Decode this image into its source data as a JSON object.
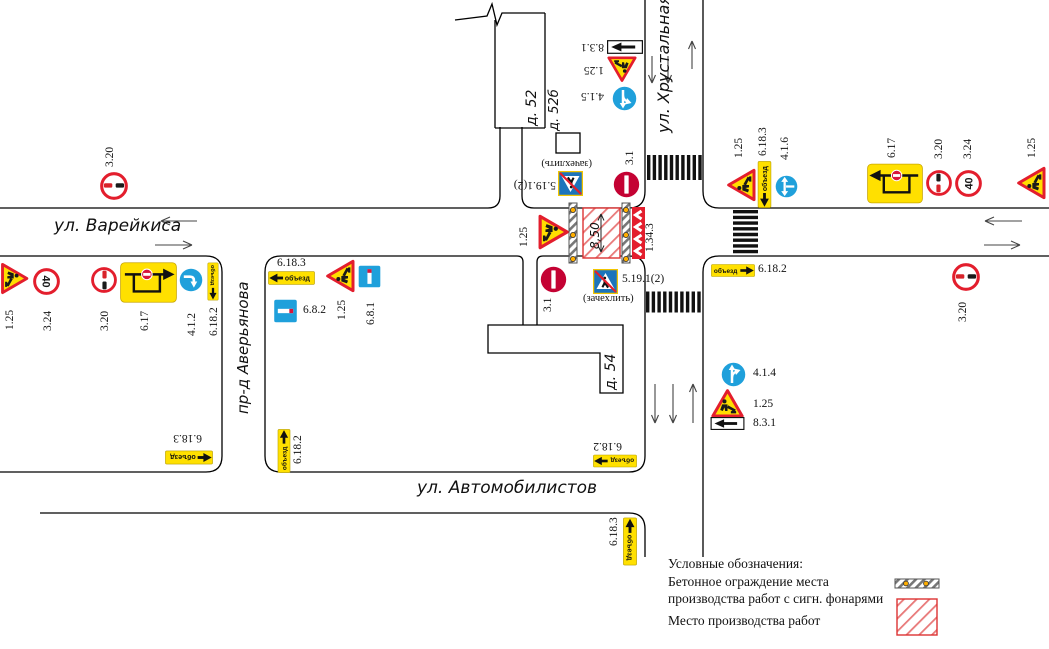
{
  "streets": [
    {
      "name": "street-label-vareykisa",
      "text": "ул. Варейкиса",
      "x": 54,
      "y": 216,
      "rot": 0,
      "size": 17
    },
    {
      "name": "street-label-khrustalnaya",
      "text": "ул. Хрустальная",
      "x": 654,
      "y": 133,
      "rot": -90,
      "size": 16
    },
    {
      "name": "street-label-averyanova",
      "text": "пр-д Аверьянова",
      "x": 234,
      "y": 414,
      "rot": -90,
      "size": 15
    },
    {
      "name": "street-label-avtomobilistov",
      "text": "ул. Автомобилистов",
      "x": 417,
      "y": 478,
      "rot": 0,
      "size": 17
    }
  ],
  "buildings": [
    {
      "name": "building-label-d52",
      "text": "д. 52",
      "x": 524,
      "y": 126,
      "rot": -90,
      "size": 14
    },
    {
      "name": "building-label-d52b",
      "text": "д. 52б",
      "x": 547,
      "y": 131,
      "rot": -90,
      "size": 13
    },
    {
      "name": "building-label-d54",
      "text": "д. 54",
      "x": 603,
      "y": 390,
      "rot": -90,
      "size": 14
    }
  ],
  "workzone": {
    "dimension": "8,50",
    "dim_x": 588,
    "dim_y": 249,
    "dim_rot": -90,
    "dim_size": 12
  },
  "legend": {
    "title": "Условные обозначения:",
    "item1_line1": "Бетонное ограждение места",
    "item1_line2": "производства работ с сигн. фонарями",
    "item2": "Место производства работ"
  },
  "signs": [
    {
      "name": "sign-320-nw",
      "code": "3.20",
      "type": "c320",
      "x": 114,
      "y": 186,
      "w": 28,
      "h": 28,
      "rot": 0,
      "label": {
        "x": 104,
        "y": 167,
        "rot": -90
      }
    },
    {
      "name": "sign-125-w",
      "code": "1.25",
      "type": "tri",
      "x": 15,
      "y": 278,
      "w": 32,
      "h": 29,
      "rot": 90,
      "label": {
        "x": 4,
        "y": 330,
        "rot": -90
      }
    },
    {
      "name": "sign-324-w",
      "code": "3.24",
      "type": "c40",
      "value": "40",
      "x": 46,
      "y": 281,
      "w": 27,
      "h": 27,
      "rot": 90,
      "label": {
        "x": 42,
        "y": 331,
        "rot": -90
      }
    },
    {
      "name": "sign-320-w",
      "code": "3.20",
      "type": "c320",
      "x": 104,
      "y": 280,
      "w": 26,
      "h": 26,
      "rot": 90,
      "label": {
        "x": 99,
        "y": 331,
        "rot": -90
      }
    },
    {
      "name": "sign-617-w",
      "code": "6.17",
      "type": "scheme",
      "variant": "right",
      "x": 148,
      "y": 282,
      "w": 57,
      "h": 41,
      "rot": 0,
      "label": {
        "x": 139,
        "y": 331,
        "rot": -90
      }
    },
    {
      "name": "sign-412-w",
      "code": "4.1.2",
      "type": "cblue",
      "variant": "right",
      "x": 191,
      "y": 280,
      "w": 24,
      "h": 24,
      "rot": 90,
      "label": {
        "x": 186,
        "y": 336,
        "rot": -90
      }
    },
    {
      "name": "sign-6182-w",
      "code": "6.18.2",
      "type": "plate",
      "variant": "right",
      "text": "объезд",
      "x": 213,
      "y": 281,
      "w": 38,
      "h": 13,
      "rot": 90,
      "label": {
        "x": 208,
        "y": 336,
        "rot": -90
      }
    },
    {
      "name": "sign-6183-mid",
      "code": "6.18.3",
      "type": "plate",
      "variant": "left",
      "text": "объезд",
      "x": 291,
      "y": 278,
      "w": 47,
      "h": 16,
      "rot": 0,
      "label": {
        "x": 277,
        "y": 257,
        "rot": 0
      }
    },
    {
      "name": "sign-682-mid",
      "code": "6.8.2",
      "type": "dead",
      "variant": "h",
      "x": 285,
      "y": 311,
      "w": 25,
      "h": 24,
      "rot": 0,
      "label": {
        "x": 303,
        "y": 304,
        "rot": 0
      }
    },
    {
      "name": "sign-125-mid",
      "code": "1.25",
      "type": "tri",
      "x": 340,
      "y": 276,
      "w": 34,
      "h": 30,
      "rot": -90,
      "label": {
        "x": 336,
        "y": 320,
        "rot": -90
      }
    },
    {
      "name": "sign-681-mid",
      "code": "6.8.1",
      "type": "dead",
      "variant": "v",
      "x": 369,
      "y": 276,
      "w": 23,
      "h": 23,
      "rot": 0,
      "label": {
        "x": 365,
        "y": 325,
        "rot": -90
      }
    },
    {
      "name": "sign-125-center",
      "code": "1.25",
      "type": "tri",
      "x": 554,
      "y": 232,
      "w": 36,
      "h": 32,
      "rot": 90,
      "label": {
        "x": 518,
        "y": 247,
        "rot": -90
      }
    },
    {
      "name": "sign-31-north",
      "code": "3.1",
      "type": "c31",
      "x": 626,
      "y": 184,
      "w": 27,
      "h": 27,
      "rot": 90,
      "label": {
        "x": 624,
        "y": 165,
        "rot": -90
      }
    },
    {
      "name": "sign-51912-north",
      "code": "5.19.1(2)",
      "type": "ped",
      "x": 570,
      "y": 183,
      "w": 25,
      "h": 25,
      "rot": 180,
      "label": {
        "x": 556,
        "y": 191,
        "rot": 180,
        "w": 60
      },
      "sub": {
        "text": "(зачехлить)",
        "x": 592,
        "y": 169,
        "rot": 180,
        "w": 60
      }
    },
    {
      "name": "sign-31-south",
      "code": "3.1",
      "type": "c31",
      "x": 553,
      "y": 279,
      "w": 27,
      "h": 27,
      "rot": 90,
      "label": {
        "x": 542,
        "y": 312,
        "rot": -90
      }
    },
    {
      "name": "sign-51912-south",
      "code": "5.19.1(2)",
      "type": "ped",
      "x": 605,
      "y": 281,
      "w": 25,
      "h": 25,
      "rot": 0,
      "label": {
        "x": 622,
        "y": 273,
        "rot": 0
      },
      "sub": {
        "text": "(зачехлить)",
        "x": 583,
        "y": 293,
        "rot": 0
      }
    },
    {
      "name": "sign-1343-chevron",
      "code": "1.34.3",
      "type": "chev",
      "x": 638,
      "y": 233,
      "w": 13,
      "h": 52,
      "rot": 0,
      "label": {
        "x": 644,
        "y": 252,
        "rot": -90
      }
    },
    {
      "name": "sign-831-north",
      "code": "8.3.1",
      "type": "p831",
      "variant": "right",
      "x": 625,
      "y": 47,
      "w": 36,
      "h": 14,
      "rot": 180,
      "label": {
        "x": 604,
        "y": 53,
        "rot": 180,
        "w": 28
      }
    },
    {
      "name": "sign-125-north",
      "code": "1.25",
      "type": "tri",
      "x": 622,
      "y": 69,
      "w": 30,
      "h": 27,
      "rot": 180,
      "label": {
        "x": 604,
        "y": 76,
        "rot": 180,
        "w": 26
      }
    },
    {
      "name": "sign-415-north",
      "code": "4.1.5",
      "type": "cblue",
      "variant": "fork-left",
      "x": 624,
      "y": 98,
      "w": 25,
      "h": 25,
      "rot": 180,
      "label": {
        "x": 604,
        "y": 102,
        "rot": 180,
        "w": 28
      }
    },
    {
      "name": "sign-125-e1",
      "code": "1.25",
      "type": "tri",
      "x": 741,
      "y": 185,
      "w": 34,
      "h": 30,
      "rot": -90,
      "label": {
        "x": 733,
        "y": 158,
        "rot": -90
      }
    },
    {
      "name": "sign-6183-e",
      "code": "6.18.3",
      "type": "plate",
      "variant": "left",
      "text": "объезд",
      "x": 764,
      "y": 184,
      "w": 47,
      "h": 15,
      "rot": -90,
      "label": {
        "x": 757,
        "y": 156,
        "rot": -90
      }
    },
    {
      "name": "sign-416-e",
      "code": "4.1.6",
      "type": "cblue",
      "variant": "left-right",
      "x": 786,
      "y": 186,
      "w": 23,
      "h": 23,
      "rot": -90,
      "label": {
        "x": 779,
        "y": 160,
        "rot": -90
      }
    },
    {
      "name": "sign-617-e",
      "code": "6.17",
      "type": "scheme",
      "variant": "left",
      "x": 895,
      "y": 183,
      "w": 56,
      "h": 41,
      "rot": 0,
      "label": {
        "x": 886,
        "y": 158,
        "rot": -90
      }
    },
    {
      "name": "sign-320-e",
      "code": "3.20",
      "type": "c320",
      "x": 939,
      "y": 183,
      "w": 26,
      "h": 26,
      "rot": -90,
      "label": {
        "x": 933,
        "y": 159,
        "rot": -90
      }
    },
    {
      "name": "sign-324-e",
      "code": "3.24",
      "type": "c40",
      "value": "40",
      "x": 968,
      "y": 183,
      "w": 27,
      "h": 27,
      "rot": -90,
      "label": {
        "x": 962,
        "y": 159,
        "rot": -90
      }
    },
    {
      "name": "sign-125-e2",
      "code": "1.25",
      "type": "tri",
      "x": 1031,
      "y": 183,
      "w": 34,
      "h": 30,
      "rot": -90,
      "label": {
        "x": 1026,
        "y": 158,
        "rot": -90
      }
    },
    {
      "name": "sign-6182-e",
      "code": "6.18.2",
      "type": "plate",
      "variant": "right",
      "text": "объезд",
      "x": 733,
      "y": 270,
      "w": 44,
      "h": 15,
      "rot": 0,
      "label": {
        "x": 758,
        "y": 263,
        "rot": 0
      }
    },
    {
      "name": "sign-320-se",
      "code": "3.20",
      "type": "c320",
      "x": 966,
      "y": 277,
      "w": 28,
      "h": 28,
      "rot": 0,
      "label": {
        "x": 957,
        "y": 322,
        "rot": -90
      }
    },
    {
      "name": "sign-414-s",
      "code": "4.1.4",
      "type": "cblue",
      "variant": "fork-right",
      "x": 733,
      "y": 374,
      "w": 25,
      "h": 25,
      "rot": 0,
      "label": {
        "x": 753,
        "y": 367,
        "rot": 0
      }
    },
    {
      "name": "sign-125-s",
      "code": "1.25",
      "type": "tri",
      "x": 727,
      "y": 403,
      "w": 35,
      "h": 30,
      "rot": 0,
      "label": {
        "x": 753,
        "y": 398,
        "rot": 0
      }
    },
    {
      "name": "sign-831-s",
      "code": "8.3.1",
      "type": "p831",
      "variant": "left",
      "x": 727,
      "y": 423,
      "w": 35,
      "h": 13,
      "rot": 0,
      "label": {
        "x": 753,
        "y": 417,
        "rot": 0
      }
    },
    {
      "name": "sign-6182-sw",
      "code": "6.18.2",
      "type": "plate",
      "variant": "right",
      "text": "объезд",
      "x": 284,
      "y": 451,
      "w": 44,
      "h": 14,
      "rot": -90,
      "label": {
        "x": 292,
        "y": 464,
        "rot": -90
      }
    },
    {
      "name": "sign-6182-sbr",
      "code": "6.18.2",
      "type": "plate",
      "variant": "right",
      "text": "объезд",
      "x": 615,
      "y": 461,
      "w": 44,
      "h": 14,
      "rot": 180,
      "label": {
        "x": 622,
        "y": 452,
        "rot": 180,
        "w": 36
      }
    },
    {
      "name": "sign-6183-swb",
      "code": "6.18.3",
      "type": "plate",
      "variant": "left",
      "text": "объезд",
      "x": 189,
      "y": 457,
      "w": 48,
      "h": 15,
      "rot": 180,
      "label": {
        "x": 202,
        "y": 444,
        "rot": 180,
        "w": 40
      }
    },
    {
      "name": "sign-6183-sb",
      "code": "6.18.3",
      "type": "plate",
      "variant": "left",
      "text": "объезд",
      "x": 630,
      "y": 541,
      "w": 48,
      "h": 15,
      "rot": 90,
      "label": {
        "x": 608,
        "y": 546,
        "rot": -90
      }
    }
  ]
}
